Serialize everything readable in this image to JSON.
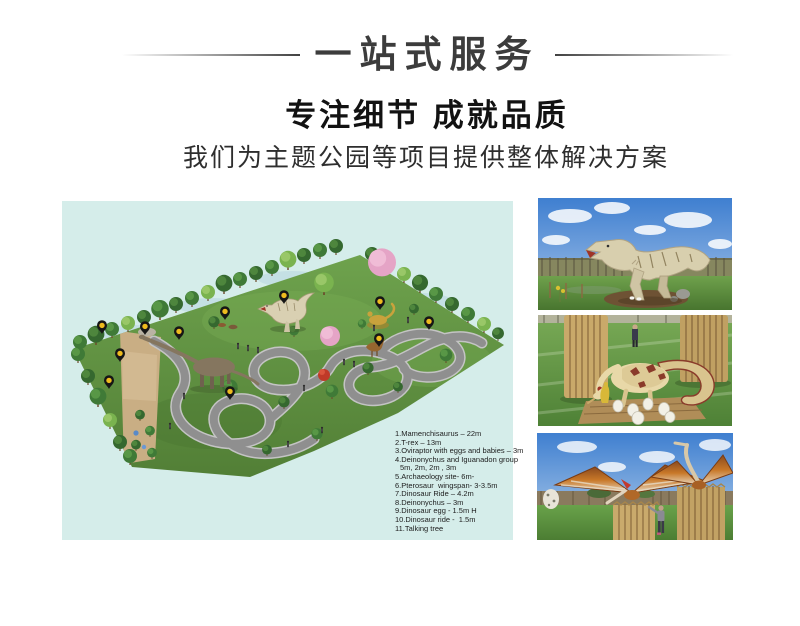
{
  "header": {
    "banner_title": "一站式服务",
    "headline": "专注细节 成就品质",
    "subheadline": "我们为主题公园等项目提供整体解决方案"
  },
  "park_map": {
    "name": "dinosaur-theme-park-master-plan",
    "legend_lines": [
      {
        "text": "1.Mamenchisaurus – 22m",
        "indent": false
      },
      {
        "text": "2.T-rex – 13m",
        "indent": false
      },
      {
        "text": "3.Oviraptor with eggs and babies – 3m",
        "indent": false
      },
      {
        "text": "4.Deinonychus and Iguanadon group",
        "indent": false
      },
      {
        "text": "5m, 2m, 2m , 3m",
        "indent": true
      },
      {
        "text": "5.Archaeology site- 6m-",
        "indent": false
      },
      {
        "text": "6.Pterosaur  wingspan- 3-3.5m",
        "indent": false
      },
      {
        "text": "7.Dinosaur Ride – 4.2m",
        "indent": false
      },
      {
        "text": "8.Deinonychus – 3m",
        "indent": false
      },
      {
        "text": "9.Dinosaur egg - 1.5m H",
        "indent": false
      },
      {
        "text": "10.Dinosaur ride -  1.5m",
        "indent": false
      },
      {
        "text": "11.Talking tree",
        "indent": false
      }
    ]
  },
  "photos": [
    {
      "name": "t-rex-model-photo"
    },
    {
      "name": "oviraptor-with-eggs-photo"
    },
    {
      "name": "pterosaur-models-photo"
    }
  ],
  "colors": {
    "map_background": "#d5edea",
    "pin_black": "#161616",
    "pin_yellow": "#eebb1e",
    "title_text": "#3c3c3c"
  }
}
